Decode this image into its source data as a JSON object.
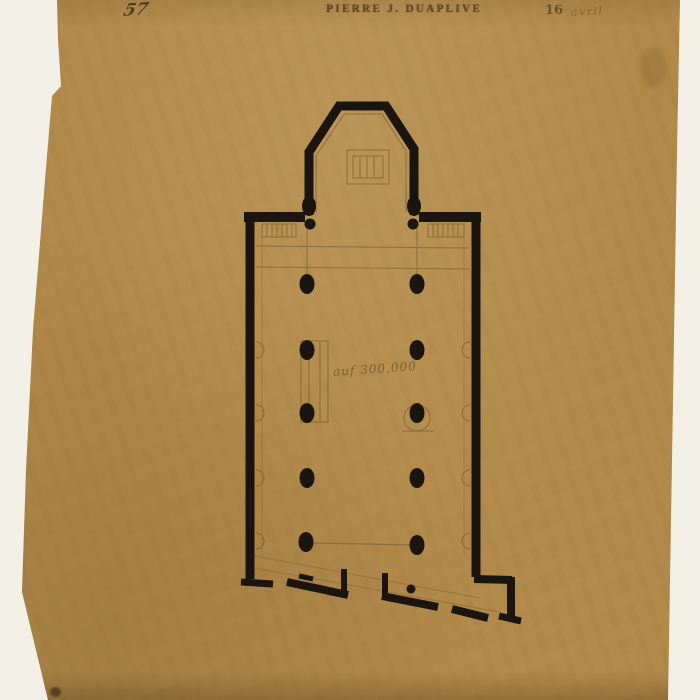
{
  "colors": {
    "background": "#f2efe6",
    "paper": "#b1894a",
    "ink": "#1a150f",
    "pencil": "#6d5426"
  },
  "header": {
    "left_number": "57",
    "stamp": "PIERRE J. DUAPLIVE",
    "right_number": "16",
    "right_script": "avril"
  },
  "plan": {
    "center_note": "auf 300,000"
  }
}
